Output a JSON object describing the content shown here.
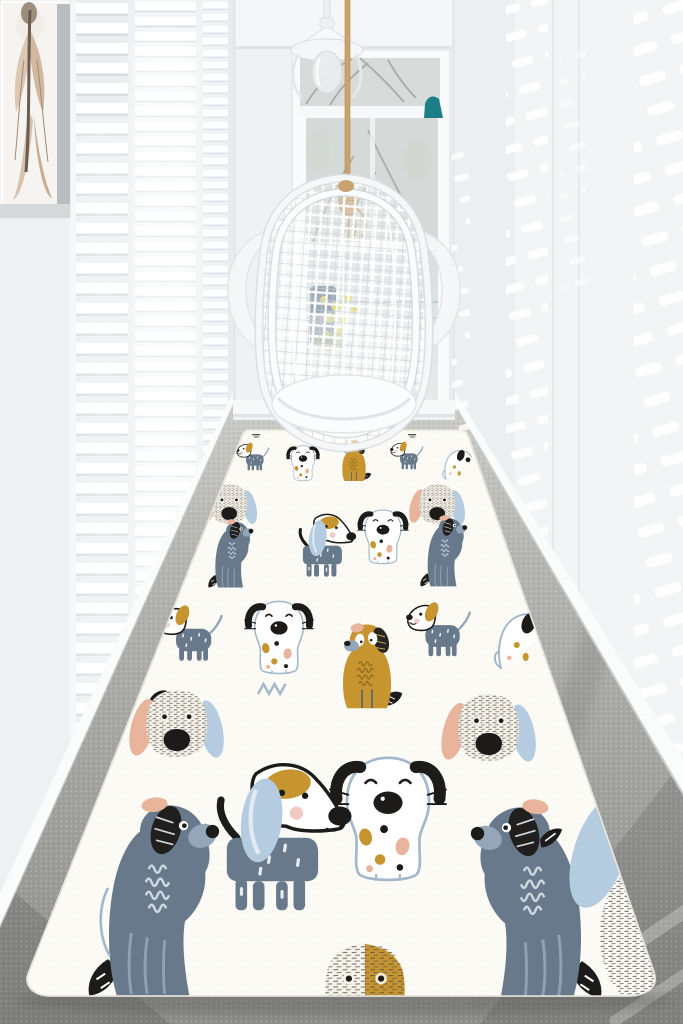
{
  "scene": {
    "type": "interior photograph (no text present)",
    "description": "Bright white hallway lined with louvered plantation shutters; a white rattan egg chair hangs from a jute rope in front of a glazed garden door; a long white runner rug printed with cartoon dogs covers the grey carpet",
    "objects": [
      {
        "name": "picture-frame",
        "detail": "white shadow-box frame with beige feather artwork, top left"
      },
      {
        "name": "louvered-shutters",
        "detail": "floor-to-ceiling white shutters glowing with daylight, left wall"
      },
      {
        "name": "sunlight-dapples",
        "detail": "slatted light spots falling on the right wall"
      },
      {
        "name": "garden-door",
        "detail": "white glazed door and transom window with bare trees outside"
      },
      {
        "name": "barn-lamp",
        "detail": "white barn-style lamp mounted above the door"
      },
      {
        "name": "teal-sconce",
        "detail": "small teal wedge lamp at the top right of the door"
      },
      {
        "name": "hanging-egg-chair",
        "detail": "white rattan swing chair on a rope with a tassel knot"
      },
      {
        "name": "carpet-floor",
        "detail": "grey speckled wall-to-wall carpet"
      },
      {
        "name": "dog-rug",
        "detail": "white runner rug with rounded corners and a hand-drawn dog pattern, perspective receding to the door"
      }
    ]
  },
  "rug": {
    "motifs": [
      "large blue-grey sitting dog with black striped ear and peach patch",
      "white sitting dog with black droopy ears, big black nose and mustard/peach spots",
      "mustard yellow sitting dog with dark hatched ear",
      "standing dog with long light-blue ear, mustard eye patch and spotted grey body",
      "big dog face with scribbled fur and long peach + blue ears",
      "small white dog with mustard ear and dotted grey-blue sweater",
      "outline dog sketches, black feather leaves and tiny scribble marks"
    ]
  },
  "palette": {
    "wall": "#f2f4f5",
    "wall-shadow": "#e3e6e9",
    "end-wall": "#eff1f3",
    "shutter-slat": "#d9dee2",
    "floor-far": "#c9cac6",
    "floor": "#a6a6a3",
    "floor-dark": "#8d8d8a",
    "rug": "#fcfbf5",
    "rug-edge": "#e6e4db",
    "dog-gray": "#68798b",
    "dog-gray-light": "#93a7b8",
    "ear-blue": "#b5cbdf",
    "mustard": "#c6952f",
    "peach": "#e9b49c",
    "pink": "#f0bfb6",
    "ink": "#1c1b19",
    "outline-blue": "#a2b7ca",
    "squiggle-brown": "#8f6d1f",
    "scribble": "#55504a",
    "rope": "#c9a36d",
    "teal": "#1c7e88",
    "glass-tree": "#a3a89f",
    "glass-sky": "#d7dbd9",
    "flower-yellow": "#ddd348"
  }
}
